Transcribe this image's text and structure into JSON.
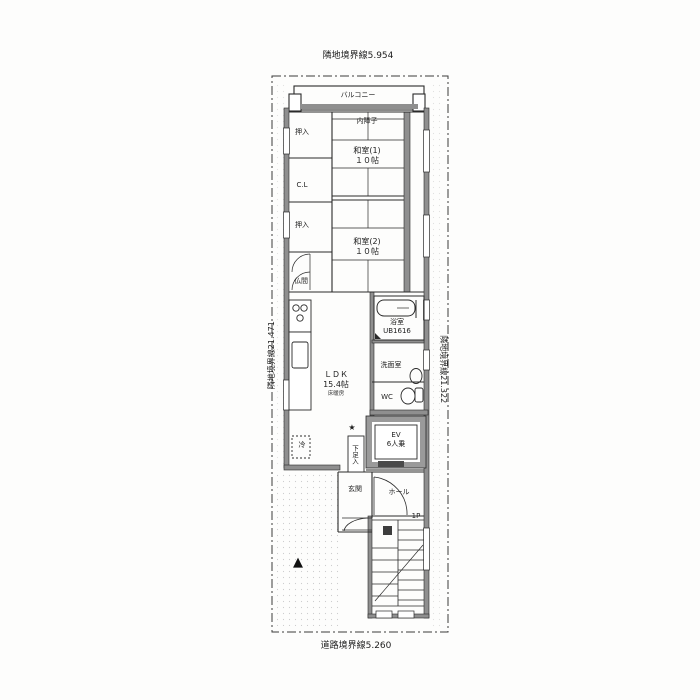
{
  "boundary_labels": {
    "top": "隣地境界線5.954",
    "bottom": "道路境界線5.260",
    "left": "隣地境界線21.471",
    "right": "隣地境界線21.322"
  },
  "rooms": {
    "balcony": {
      "label": "バルコニー"
    },
    "inner_shoji": {
      "label": "内障子"
    },
    "washitsu1": {
      "name": "和室(1)",
      "size": "１０帖"
    },
    "washitsu2": {
      "name": "和室(2)",
      "size": "１０帖"
    },
    "oshiire_upper": {
      "label": "押入"
    },
    "closet": {
      "label": "C.L"
    },
    "oshiire_lower": {
      "label": "押入"
    },
    "butsuma": {
      "label": "仏間"
    },
    "ldk": {
      "name": "ＬＤＫ",
      "size": "15.4帖",
      "note": "床暖房"
    },
    "bathroom": {
      "name": "浴室",
      "size": "UB1616"
    },
    "washroom": {
      "label": "洗面室"
    },
    "wc": {
      "label": "WC"
    },
    "elevator": {
      "name": "EV",
      "capacity": "6人乗"
    },
    "shoe_cabinet": {
      "label": "下足入"
    },
    "refrigerator": {
      "label": "冷"
    },
    "genkan": {
      "label": "玄関"
    },
    "hall": {
      "label": "ホール"
    },
    "stairs": {
      "label": "1P"
    }
  },
  "symbols": {
    "star_marker": "★",
    "direction_marker": "▲"
  },
  "colors": {
    "line": "#2a2a2a",
    "wall": "#8f8f8f",
    "paper": "#fdfdfc"
  }
}
